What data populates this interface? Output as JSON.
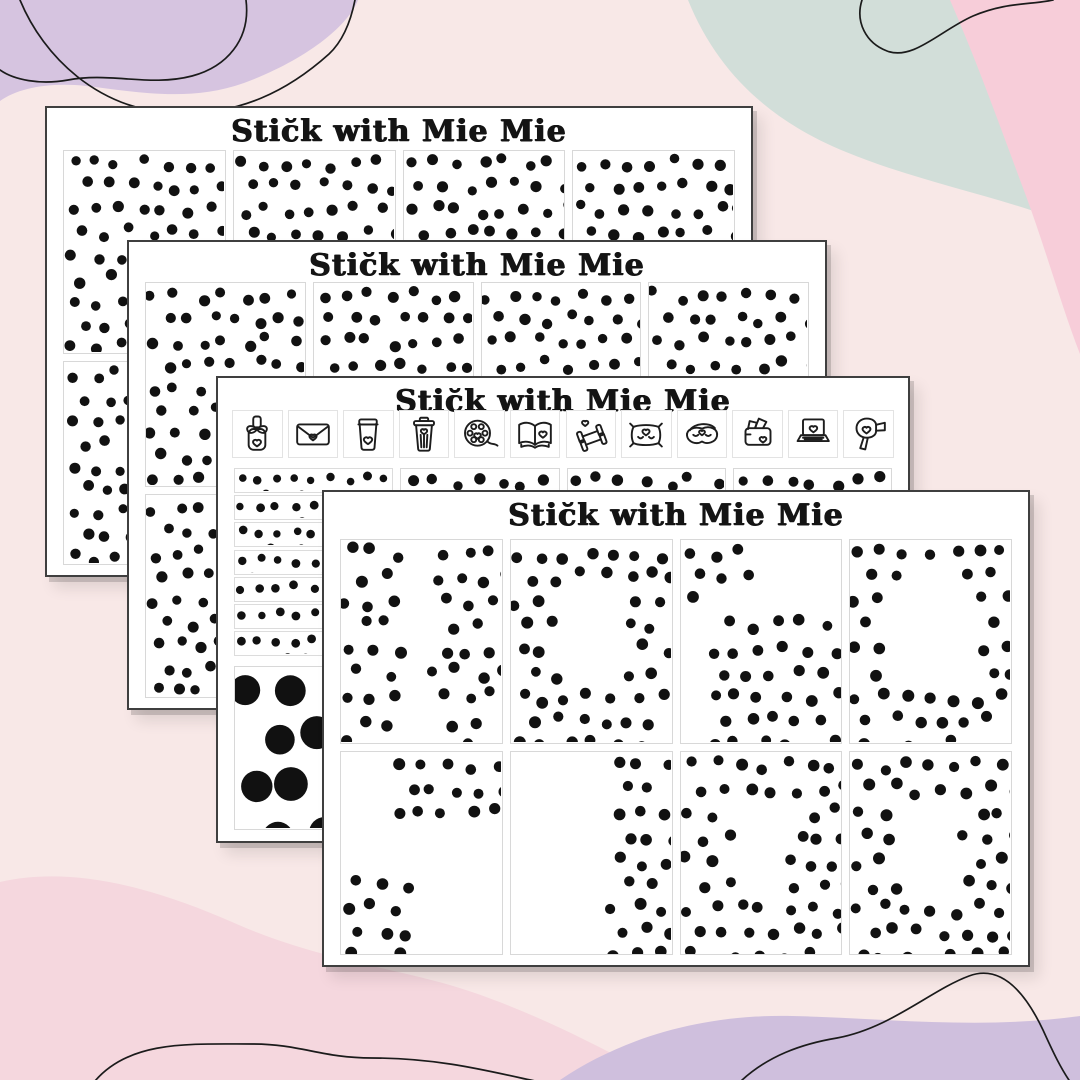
{
  "colors": {
    "page_background": "#f8e8e7",
    "lavender_top": "#d6c4e0",
    "mint_top_right": "#d2ded9",
    "rose_corner": "#f7cdd9",
    "pink_bottom": "#f5d7de",
    "lavender_bottom": "#cfbfdd",
    "squiggle_line": "#1b1b1b",
    "dot": "#111111",
    "paper": "#ffffff"
  },
  "sheets": [
    {
      "id": "sheet-1",
      "title": "Stic̆k with Mie Mie",
      "rows": [
        [
          "full",
          "full",
          "full",
          "full"
        ],
        [
          "full",
          "full",
          "full",
          "full"
        ]
      ]
    },
    {
      "id": "sheet-2",
      "title": "Stic̆k with Mie Mie",
      "rows": [
        [
          "full",
          "full",
          "full",
          "full"
        ],
        [
          "full",
          "full",
          "full",
          "full"
        ]
      ]
    },
    {
      "id": "sheet-3",
      "title": "Stic̆k with Mie Mie",
      "icons": [
        "nail-polish",
        "envelope",
        "coffee-cup",
        "trash-can",
        "film-reel",
        "open-book",
        "dumbbells",
        "pillow",
        "sleep-mask",
        "wallet",
        "laptop",
        "hair-dryer"
      ],
      "strip_count": 7,
      "strip_pattern": "full",
      "big_dot_box_pattern": "full",
      "rows": [
        [
          "full",
          "full",
          "full"
        ],
        [
          "full",
          "full",
          "full"
        ]
      ]
    },
    {
      "id": "sheet-4",
      "title": "Stic̆k with Mie Mie",
      "rows": [
        [
          "sides",
          "frame",
          "corners-tl-br",
          "ring"
        ],
        [
          "corners-tr-bl",
          "right-edge",
          "frame",
          "frame"
        ]
      ]
    }
  ]
}
